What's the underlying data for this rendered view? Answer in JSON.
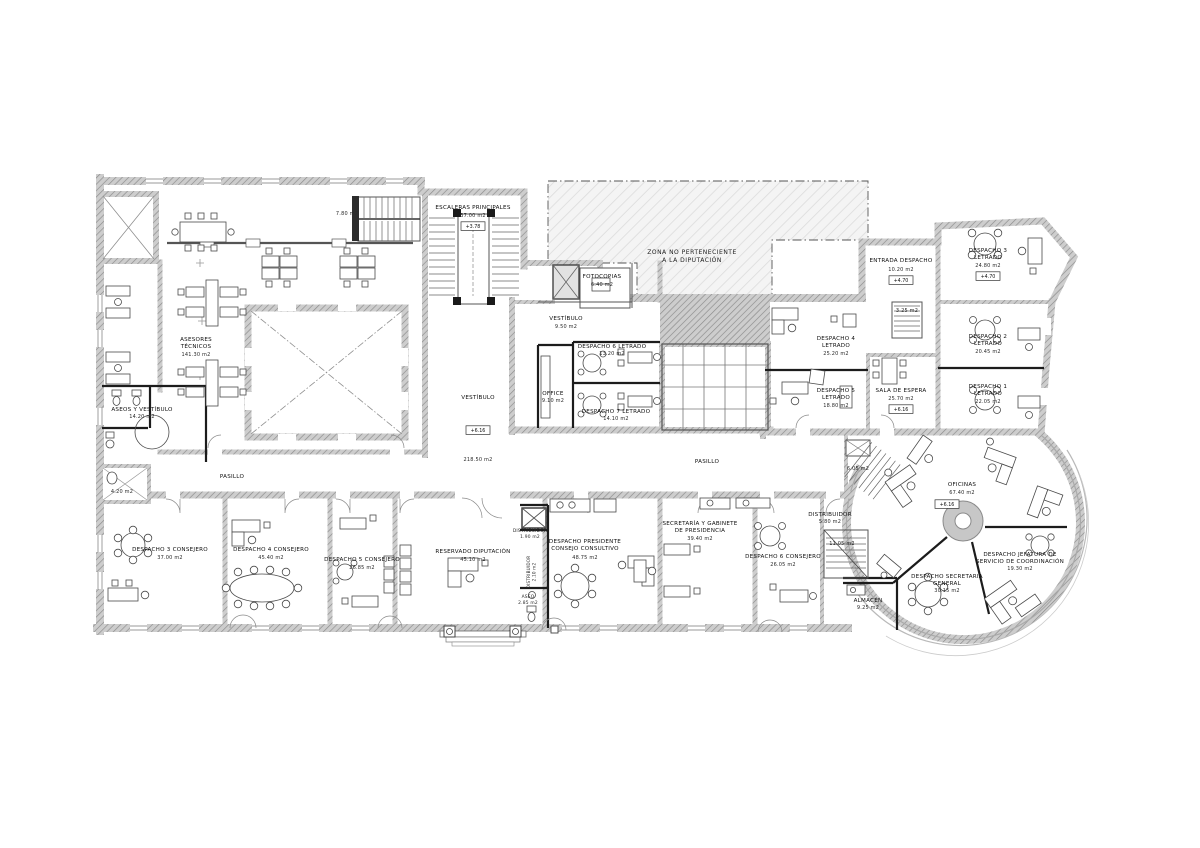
{
  "palette": {
    "paper": "#ffffff",
    "wall_fill": "#cdcdcd",
    "wall_hatch": "#8a8a8a",
    "zone_fill": "#f4f4f4",
    "zone_hatch": "#dddddd",
    "line": "#444444",
    "text": "#111111"
  },
  "zone": {
    "l1": "ZONA NO PERTENECIENTE",
    "l2": "A LA DIPUTACIÓN"
  },
  "rooms": [
    {
      "id": "escaleras-principales",
      "l1": "ESCALERAS PRINCIPALES",
      "area": "37.00 m2",
      "elev": "+3.78"
    },
    {
      "id": "escalera-780",
      "area": "7.80 m2"
    },
    {
      "id": "asesores-tecnicos",
      "l1": "ASESORES",
      "l2": "TÉCNICOS",
      "area": "141.30 m2"
    },
    {
      "id": "aseos-y-vestibulo",
      "l1": "ASEOS Y VESTÍBULO",
      "area": "14.20 m2"
    },
    {
      "id": "cuarto-420",
      "area": "4.20 m2"
    },
    {
      "id": "pasillo-izquierdo",
      "l1": "PASILLO"
    },
    {
      "id": "vestibulo-central",
      "l1": "VESTÍBULO",
      "area": "218.50 m2",
      "elev": "+6.16"
    },
    {
      "id": "vestibulo-pequeno",
      "l1": "VESTÍBULO",
      "area": "9.50 m2"
    },
    {
      "id": "fotocopias",
      "l1": "FOTOCOPIAS",
      "area": "6.40 m2"
    },
    {
      "id": "despacho-6-letrado",
      "l1": "DESPACHO 6 LETRADO",
      "area": "13.20 m2"
    },
    {
      "id": "office",
      "l1": "OFFICE",
      "area": "9.10 m2"
    },
    {
      "id": "despacho-7-letrado",
      "l1": "DESPACHO 7 LETRADO",
      "area": "14.10 m2"
    },
    {
      "id": "pasillo-derecho",
      "l1": "PASILLO"
    },
    {
      "id": "entrada-despacho",
      "l1": "ENTRADA DESPACHO",
      "area": "10.20 m2",
      "elev": "+4.70"
    },
    {
      "id": "despacho-3-letrado",
      "l1": "DESPACHO 3",
      "l2": "LETRADO",
      "area": "24.80 m2",
      "elev": "+4.70"
    },
    {
      "id": "despacho-4-letrado",
      "l1": "DESPACHO 4",
      "l2": "LETRADO",
      "area": "25.20 m2"
    },
    {
      "id": "escalera-325",
      "area": "3.25 m2"
    },
    {
      "id": "despacho-2-letrado",
      "l1": "DESPACHO 2",
      "l2": "LETRADO",
      "area": "20.45 m2"
    },
    {
      "id": "despacho-5-letrado",
      "l1": "DESPACHO 5",
      "l2": "LETRADO",
      "area": "18.80 m2"
    },
    {
      "id": "sala-de-espera",
      "l1": "SALA DE ESPERA",
      "area": "25.70 m2",
      "elev": "+6.16"
    },
    {
      "id": "despacho-1-letrado",
      "l1": "DESPACHO 1",
      "l2": "LETRADO",
      "area": "22.05 m2"
    },
    {
      "id": "oficinas",
      "l1": "OFICINAS",
      "area": "67.40 m2",
      "elev": "+6.16"
    },
    {
      "id": "distribuidor-rotonda",
      "l1": "DISTRIBUIDOR",
      "area": "5.80 m2"
    },
    {
      "id": "escalera-1105",
      "area": "11.05 m2"
    },
    {
      "id": "escalera-605",
      "area": "6.05 m2"
    },
    {
      "id": "almacen",
      "l1": "ALMACÉN",
      "area": "9.25 m2"
    },
    {
      "id": "despacho-secretaria-general",
      "l1": "DESPACHO SECRETARIA",
      "l2": "GENERAL",
      "area": "30.15 m2"
    },
    {
      "id": "despacho-jefatura-coordinacion",
      "l1": "DESPACHO JEFATURA DE",
      "l2": "SERVICIO DE COORDINACIÓN",
      "area": "19.30 m2"
    },
    {
      "id": "despacho-3-consejero",
      "l1": "DESPACHO 3 CONSEJERO",
      "area": "37.00 m2"
    },
    {
      "id": "despacho-4-consejero",
      "l1": "DESPACHO 4 CONSEJERO",
      "area": "45.40 m2"
    },
    {
      "id": "despacho-5-consejero",
      "l1": "DESPACHO 5 CONSEJERO",
      "area": "26.85 m2"
    },
    {
      "id": "reservado-diputacion",
      "l1": "RESERVADO DIPUTACIÓN",
      "area": "45.10 m2"
    },
    {
      "id": "distribuidor-entrada",
      "l1": "DISTRIBUIDOR",
      "area": "1.90 m2"
    },
    {
      "id": "distribuidor-aseo",
      "l1": "DISTRIBUIDOR",
      "area": "2.10 m2"
    },
    {
      "id": "aseo",
      "l1": "ASEO",
      "area": "2.85 m2"
    },
    {
      "id": "despacho-presidente",
      "l1": "DESPACHO PRESIDENTE",
      "l2": "CONSEJO CONSULTIVO",
      "area": "48.75 m2"
    },
    {
      "id": "secretaria-gabinete-presidencia",
      "l1": "SECRETARÍA Y GABINETE",
      "l2": "DE PRESIDENCIA",
      "area": "39.40 m2"
    },
    {
      "id": "despacho-6-consejero",
      "l1": "DESPACHO 6 CONSEJERO",
      "area": "26.05 m2"
    }
  ]
}
